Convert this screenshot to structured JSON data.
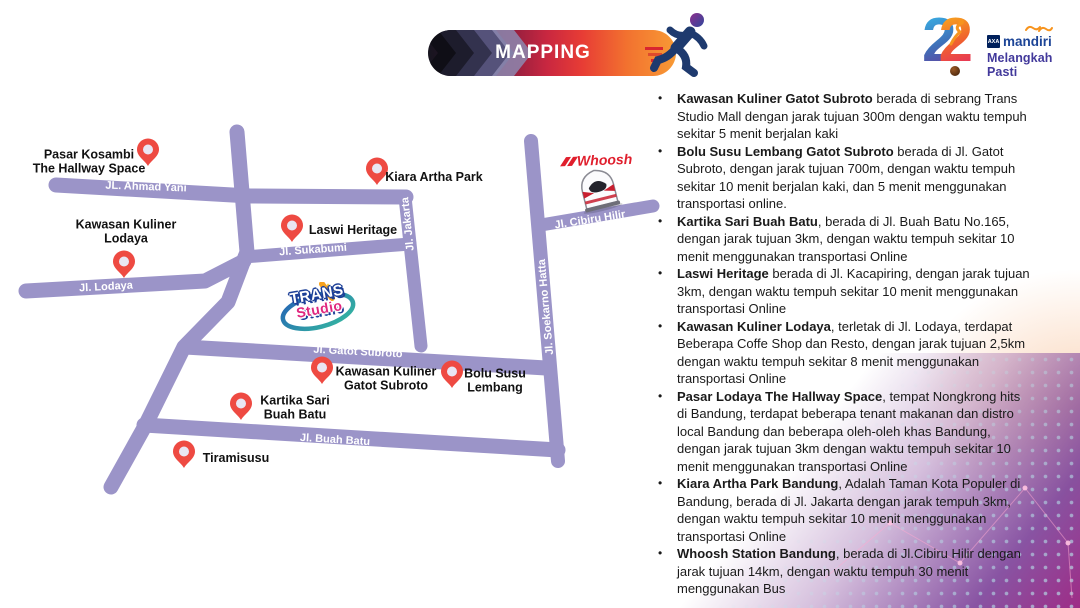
{
  "banner": {
    "label": "MAPPING"
  },
  "brand": {
    "numerals_left": "2",
    "numerals_right": "2",
    "axa": "AXA",
    "mandiri": "mandiri",
    "tagline": "Melangkah Pasti"
  },
  "map": {
    "roads": [
      {
        "label": "JL. Ahmad Yani"
      },
      {
        "label": "Jl. Lodaya"
      },
      {
        "label": "Jl. Sukabumi"
      },
      {
        "label": "Jl. Jakarta"
      },
      {
        "label": "Jl. Gatot Subroto"
      },
      {
        "label": "Jl. Buah Batu"
      },
      {
        "label": "Jl. Soekarno Hatta"
      },
      {
        "label": "Jl. Cibiru Hilir"
      }
    ],
    "places": [
      {
        "label": "Pasar Kosambi\nThe Hallway Space"
      },
      {
        "label": "Kawasan Kuliner\nLodaya"
      },
      {
        "label": "Kiara Artha Park"
      },
      {
        "label": "Laswi Heritage"
      },
      {
        "label": "Kawasan Kuliner\nGatot Subroto"
      },
      {
        "label": "Bolu Susu\nLembang"
      },
      {
        "label": "Kartika Sari\nBuah Batu"
      },
      {
        "label": "Tiramisusu"
      }
    ],
    "trans_studio": {
      "line1": "TRANS",
      "line2": "Studio"
    },
    "whoosh": {
      "label": "Whoosh"
    }
  },
  "panel": {
    "bullet_char": "•",
    "items": [
      {
        "name": "Kawasan Kuliner Gatot Subroto",
        "description": " berada di sebrang Trans Studio Mall dengan jarak tujuan 300m dengan waktu tempuh sekitar 5 menit berjalan kaki"
      },
      {
        "name": "Bolu Susu Lembang Gatot Subroto",
        "description": " berada di Jl. Gatot Subroto, dengan jarak tujuan 700m, dengan waktu tempuh sekitar 10 menit berjalan kaki, dan 5 menit menggunakan transportasi online."
      },
      {
        "name": "Kartika Sari Buah Batu",
        "description": ", berada di Jl. Buah Batu No.165, dengan jarak tujuan 3km, dengan waktu tempuh sekitar 10 menit menggunakan transportasi Online"
      },
      {
        "name": "Laswi Heritage",
        "description": " berada di Jl. Kacapiring, dengan jarak tujuan 3km, dengan waktu tempuh sekitar 10 menit menggunakan transportasi Online"
      },
      {
        "name": "Kawasan Kuliner Lodaya",
        "description": ", terletak di Jl. Lodaya, terdapat Beberapa Coffe Shop dan Resto, dengan jarak tujuan 2,5km dengan waktu tempuh sekitar 8 menit menggunakan transportasi Online"
      },
      {
        "name": "Pasar Lodaya The Hallway Space",
        "description": ", tempat Nongkrong hits di Bandung, terdapat beberapa tenant makanan dan distro local Bandung dan beberapa oleh-oleh khas Bandung, dengan jarak tujuan 3km dengan waktu tempuh sekitar 10 menit menggunakan transportasi Online"
      },
      {
        "name": "Kiara Artha Park Bandung",
        "description": ", Adalah Taman Kota Populer di Bandung, berada di Jl. Jakarta dengan jarak tempuh 3km, dengan waktu tempuh sekitar 10 menit menggunakan transportasi Online"
      },
      {
        "name": "Whoosh Station Bandung",
        "description": ", berada di Jl.Cibiru Hilir dengan jarak tujuan 14km, dengan waktu tempuh 30 menit menggunakan Bus"
      }
    ]
  },
  "colors": {
    "road": "#9b94c8",
    "pin": "#ee4a42",
    "pin_inner": "#e9e6f3",
    "banner_red": "#d8232f",
    "banner_orange": "#f89a35",
    "runner_navy": "#1e3a6e",
    "whoosh_red": "#e01f2d",
    "tagline_indigo": "#42399b"
  }
}
